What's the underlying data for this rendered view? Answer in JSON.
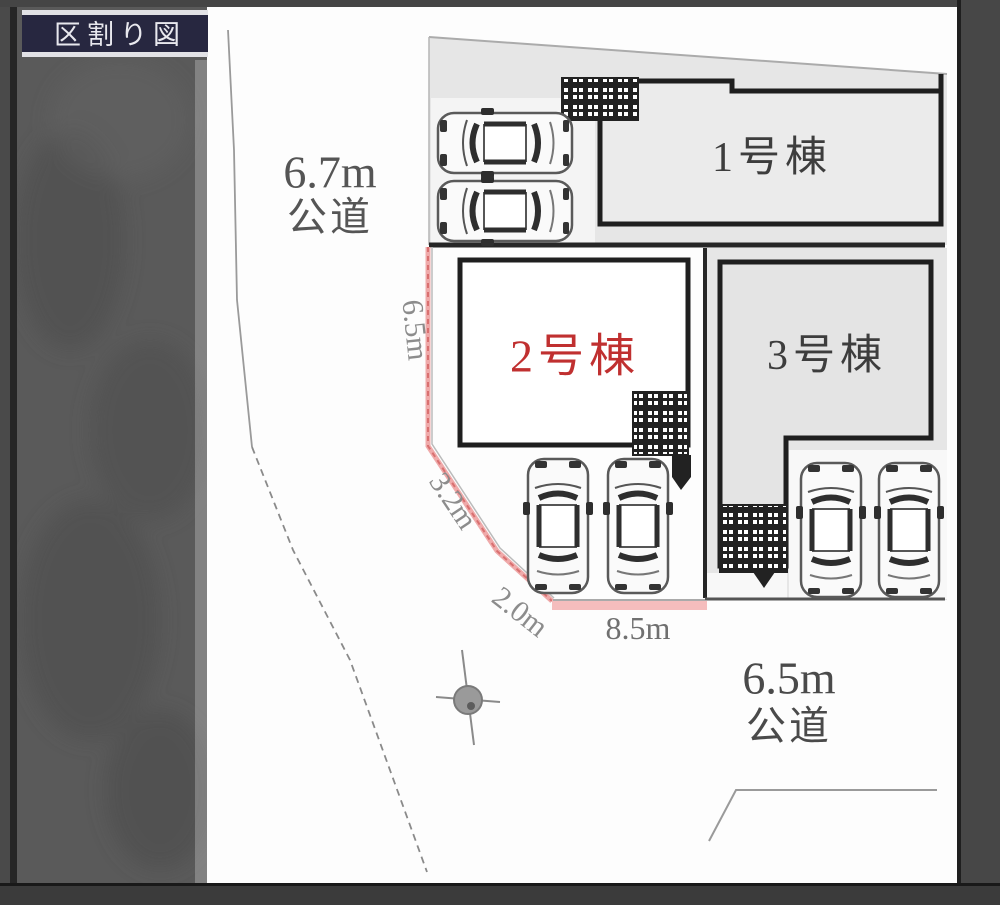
{
  "title_box": {
    "label": "区割り図"
  },
  "roads": {
    "west": {
      "width_label": "6.7m",
      "type_label": "公道"
    },
    "south": {
      "width_label": "6.5m",
      "type_label": "公道"
    }
  },
  "buildings": {
    "b1": {
      "label": "1号棟"
    },
    "b2": {
      "label": "2号棟"
    },
    "b3": {
      "label": "3号棟"
    }
  },
  "dimensions": {
    "west_side": "6.5m",
    "diag_upper": "3.2m",
    "diag_lower": "2.0m",
    "south_side": "8.5m"
  },
  "colors": {
    "highlight_red": "#c03030",
    "boundary_pink_band": "#f5bdbd",
    "title_bg": "#272740",
    "lot_gray": "#e6e6e6"
  }
}
